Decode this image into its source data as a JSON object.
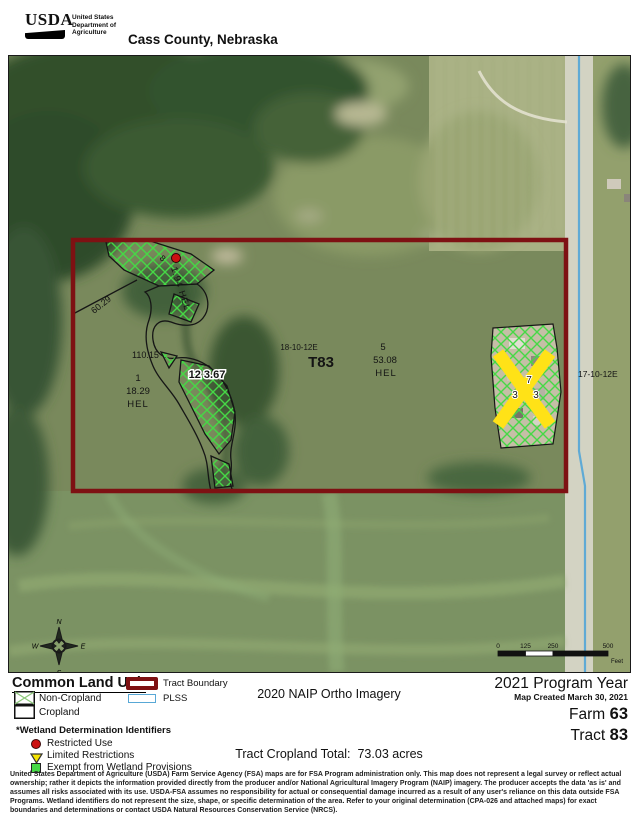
{
  "header": {
    "logo_text": "USDA",
    "agency_lines": [
      "United States",
      "Department of",
      "Agriculture"
    ],
    "title": "Cass County, Nebraska"
  },
  "map": {
    "sections": {
      "left": "18-10-12E",
      "township": "T83",
      "right": "17-10-12E"
    },
    "fields": {
      "f1": {
        "num": "1",
        "acres": "18.29",
        "cls": "HEL"
      },
      "f5": {
        "num": "5",
        "acres": "53.08",
        "cls": "HEL"
      },
      "f8": {
        "num": "8",
        "acres_cls": "1.94  HEL"
      },
      "f12": {
        "label": "12 3.67"
      },
      "f7": {
        "num": "7",
        "acres_left": "3",
        "acres_right": "3"
      },
      "boundary_60": "60.29",
      "boundary_110": "110.15"
    },
    "compass": {
      "n": "N",
      "e": "E",
      "s": "S",
      "w": "W"
    },
    "scalebar": {
      "ticks": [
        "0",
        "125",
        "250",
        "500"
      ],
      "unit": "Feet"
    }
  },
  "legend": {
    "clu_title": "Common Land Unit",
    "non_cropland": "Non-Cropland",
    "cropland": "Cropland",
    "tract_boundary": "Tract Boundary",
    "plss": "PLSS",
    "wetland_title": "*Wetland Determination Identifiers",
    "restricted": "Restricted Use",
    "limited": "Limited Restrictions",
    "exempt": "Exempt from Wetland Provisions"
  },
  "footer": {
    "imagery": "2020 NAIP Ortho Imagery",
    "program_year": "2021 Program Year",
    "map_created": "Map Created March 30, 2021",
    "farm_label": "Farm",
    "farm_value": "63",
    "tract_label": "Tract",
    "tract_value": "83",
    "cropland_total_label": "Tract Cropland Total:",
    "cropland_total_value": "73.03 acres"
  },
  "disclaimer": [
    "United States Department of Agriculture (USDA) Farm Service Agency (FSA) maps are for FSA Program administration only.  This map does not represent a legal survey or reflect actual",
    "ownership; rather it depicts the information provided directly from the producer and/or National Agricultural Imagery Program (NAIP) imagery.  The producer accepts the data 'as is' and",
    "assumes all risks associated with its use.  USDA-FSA assumes no responsibility for actual or consequential damage incurred as a result of any user's reliance on this data outside FSA",
    "Programs.  Wetland identifiers do not represent the size, shape, or specific determination of the area.  Refer to your original determination (CPA-026 and attached maps) for exact",
    "boundaries and determinations or contact USDA Natural Resources Conservation Service (NRCS)."
  ],
  "colors": {
    "tract_boundary": "#7E1113",
    "plss_line": "#58A8D6",
    "wetland_exempt_hatch": "#46D846",
    "restricted_dot": "#CC1111",
    "limited_triangle": "#F5E400",
    "crossout_x": "#FFE217"
  }
}
